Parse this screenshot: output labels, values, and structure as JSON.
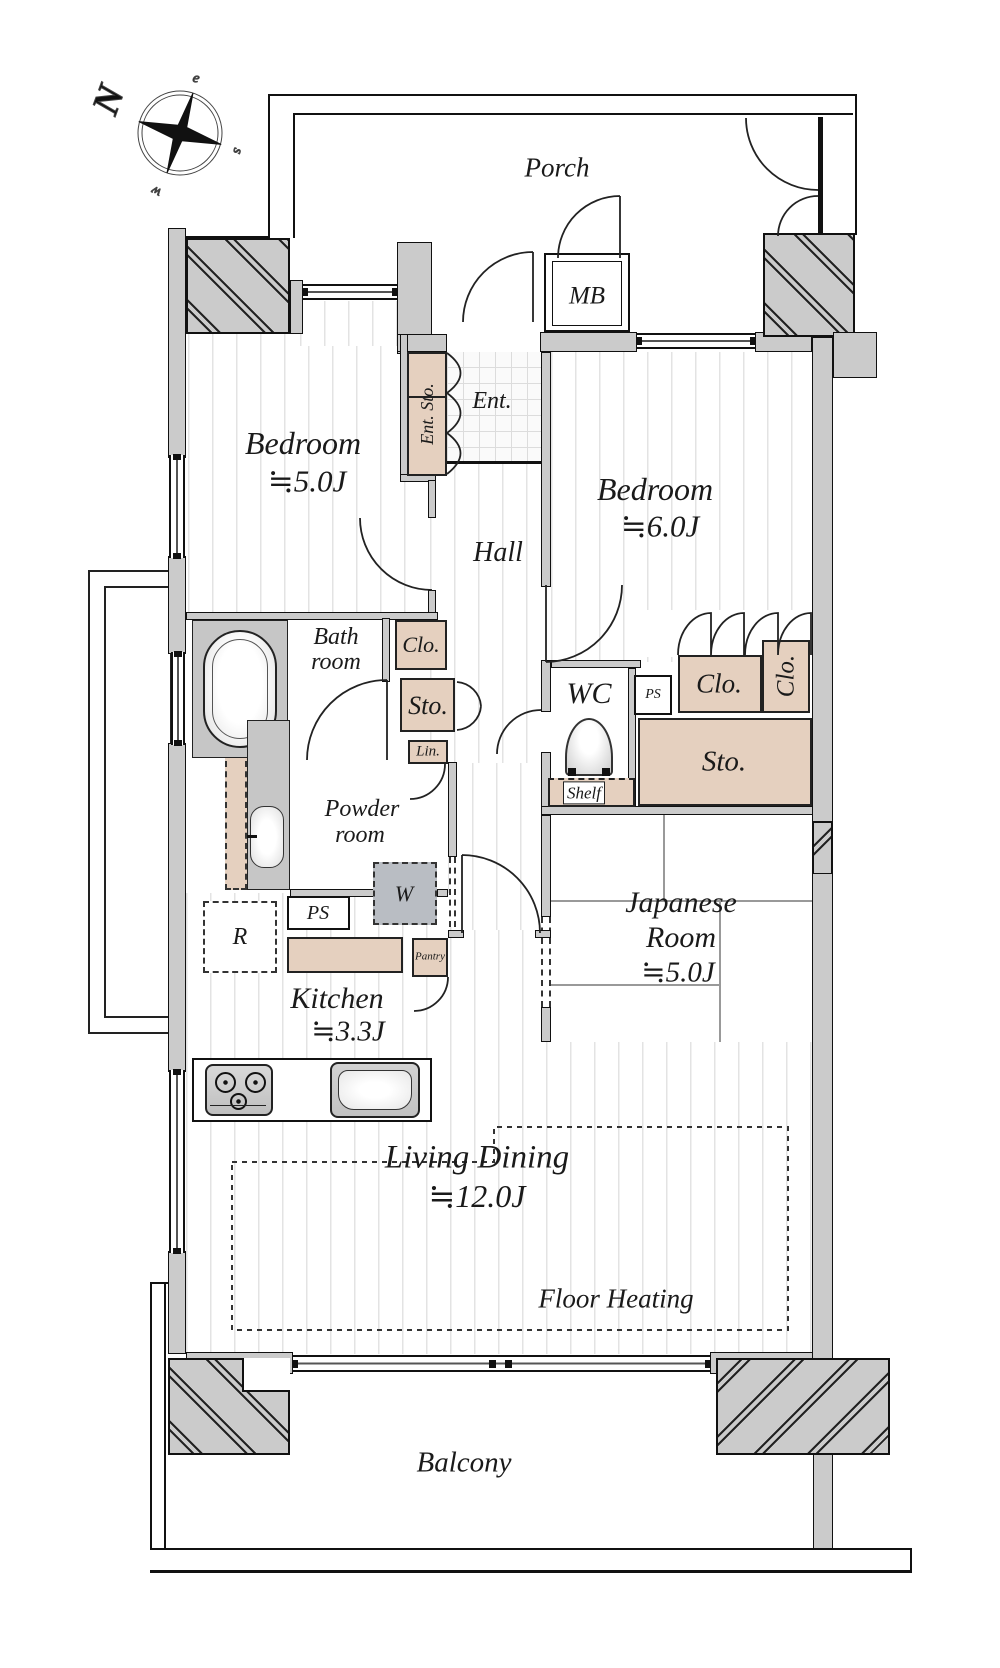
{
  "title": "apartment-floor-plan",
  "colors": {
    "wall_fill": "#cbcbcb",
    "storage_fill": "#e5d0bf",
    "line": "#1a1a1a",
    "floor_stripe": "#e3e3e3",
    "appliance_gray": "#b9bdc3"
  },
  "compass": {
    "north": "N",
    "east": "e",
    "south": "s",
    "west": "w"
  },
  "rooms": {
    "porch": {
      "label": "Porch"
    },
    "meter_box": {
      "label": "MB"
    },
    "entrance": {
      "label": "Ent."
    },
    "entrance_storage": {
      "label": "Ent. Sto."
    },
    "bedroom_west": {
      "label": "Bedroom",
      "size": "≒5.0J"
    },
    "bedroom_east": {
      "label": "Bedroom",
      "size": "≒6.0J"
    },
    "hall": {
      "label": "Hall"
    },
    "bathroom": {
      "label_line1": "Bath",
      "label_line2": "room"
    },
    "powder_room": {
      "label_line1": "Powder",
      "label_line2": "room"
    },
    "wc": {
      "label": "WC"
    },
    "kitchen": {
      "label": "Kitchen",
      "size": "≒3.3J"
    },
    "japanese_room": {
      "label_line1": "Japanese",
      "label_line2": "Room",
      "size": "≒5.0J"
    },
    "living_dining": {
      "label": "Living Dining",
      "size": "≒12.0J",
      "note": "Floor Heating"
    },
    "balcony": {
      "label": "Balcony"
    }
  },
  "storage": {
    "closet_hall": {
      "label": "Clo."
    },
    "storage_hall": {
      "label": "Sto."
    },
    "linen": {
      "label": "Lin."
    },
    "shelf": {
      "label": "Shelf"
    },
    "closet_east": {
      "label": "Clo."
    },
    "closet_east_side": {
      "label": "Clo."
    },
    "storage_east": {
      "label": "Sto."
    },
    "pantry": {
      "label": "Pantry"
    }
  },
  "utilities": {
    "ps_upper": {
      "label": "PS"
    },
    "ps_kitchen": {
      "label": "PS"
    },
    "washer": {
      "label": "W"
    },
    "refrigerator": {
      "label": "R"
    }
  }
}
